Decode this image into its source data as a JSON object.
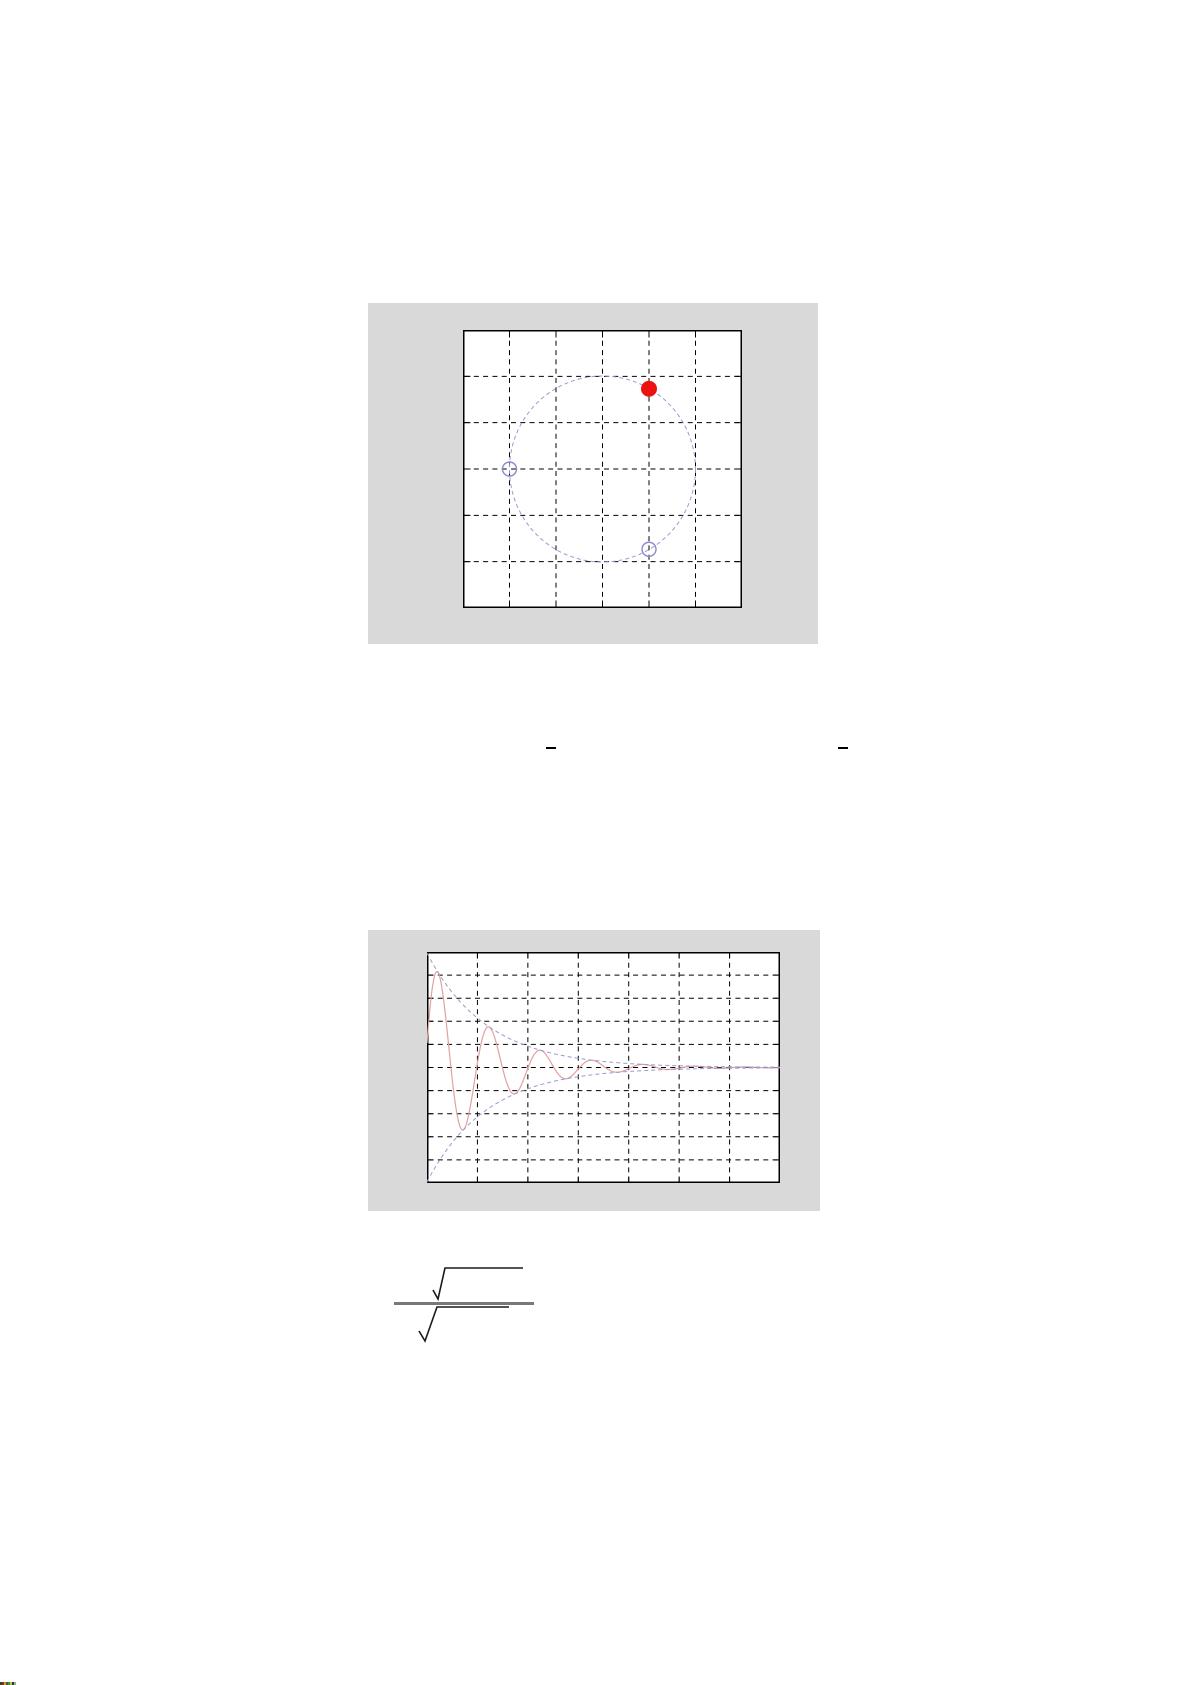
{
  "page": {
    "width": 1191,
    "height": 1685,
    "background": "#ffffff",
    "description": "White document page containing two MATLAB-style figures (a pole-zero unit-circle plot and a damped oscillation plot), two small minus-sign equation fragments, a fraction formula of which only the square-root radicals and bars rendered, and a tiny multicolored artifact strip in the bottom-left corner"
  },
  "panels": {
    "figure1_color": "#d9d9d9",
    "figure2_color": "#d9d9d9"
  },
  "chart_data": [
    {
      "type": "scatter",
      "name": "pole-zero-unit-circle-plot",
      "title": "",
      "xlabel": "",
      "ylabel": "",
      "xlim": [
        -1.5,
        1.5
      ],
      "ylim": [
        -1.5,
        1.5
      ],
      "grid": {
        "cols": 6,
        "rows": 6,
        "line_style": "dashed",
        "color": "#000000",
        "dash": "5,4.3"
      },
      "frame_color": "#000000",
      "frame_width": 1.5,
      "tick_len": 6,
      "unit_circle": {
        "cx": 0,
        "cy": 0,
        "radius": 1,
        "color": "#9a9ad2",
        "dash": "4,3",
        "width": 1
      },
      "points": [
        {
          "kind": "pole",
          "marker": "filled-circle",
          "x": 0.5,
          "y": 0.866,
          "color": "#ee1111",
          "radius_px": 7.5
        },
        {
          "kind": "zero",
          "marker": "open-circle",
          "x": -1.0,
          "y": 0.0,
          "color": "#8a8ace",
          "radius_px": 7
        },
        {
          "kind": "zero",
          "marker": "open-circle",
          "x": 0.5,
          "y": -0.866,
          "color": "#8a8ace",
          "radius_px": 7
        }
      ]
    },
    {
      "type": "line",
      "name": "damped-oscillation-plot",
      "title": "",
      "xlabel": "",
      "ylabel": "",
      "xlim": [
        0,
        7
      ],
      "ylim": [
        -5,
        5
      ],
      "grid": {
        "cols": 7,
        "rows": 10,
        "line_style": "dashed",
        "color": "#000000",
        "dash": "5,4.3"
      },
      "frame_color": "#000000",
      "frame_width": 1.5,
      "tick_len": 5,
      "series": [
        {
          "name": "damped-cosine",
          "color": "#e3a0a0",
          "width": 1.2,
          "dash": "",
          "model": {
            "kind": "damped_cosine",
            "amplitude": 4.95,
            "decay_tau": 1.19,
            "period": 1.02,
            "peak_x": 0.22,
            "midline": 0
          },
          "sample_step": 0.01
        },
        {
          "name": "upper-envelope",
          "color": "#9a9ad2",
          "width": 1,
          "dash": "4,3",
          "model": {
            "kind": "exp_envelope",
            "amplitude": 4.95,
            "decay_tau": 1.19,
            "sign": 1
          },
          "sample_step": 0.05
        },
        {
          "name": "lower-envelope",
          "color": "#9a9ad2",
          "width": 1,
          "dash": "4,3",
          "model": {
            "kind": "exp_envelope",
            "amplitude": 4.95,
            "decay_tau": 1.19,
            "sign": -1
          },
          "sample_step": 0.05
        }
      ]
    }
  ],
  "equation_marks": {
    "color": "#000000",
    "bars": [
      {
        "x": 546,
        "y": 747,
        "width": 10,
        "height": 2
      },
      {
        "x": 838,
        "y": 747,
        "width": 10,
        "height": 2
      }
    ]
  },
  "formula": {
    "description": "Fraction: square root expression over square root expression; only radical signs, vinculums and the fraction bar are visible",
    "stroke_color": "#1a1a1a",
    "stroke_width": 1.6,
    "bar": {
      "x": 6,
      "y": 44,
      "width": 140,
      "height": 3,
      "color": "#787878"
    },
    "radicals": [
      {
        "name": "numerator-radical",
        "points": [
          [
            45,
            32
          ],
          [
            50,
            41
          ],
          [
            57,
            10
          ],
          [
            135,
            10
          ]
        ]
      },
      {
        "name": "denominator-radical",
        "points": [
          [
            31,
            73
          ],
          [
            37,
            83
          ],
          [
            49,
            49
          ],
          [
            121,
            49
          ]
        ]
      }
    ]
  },
  "corner_artifact": {
    "x": 0,
    "y": 1682,
    "segment_width": 2,
    "height": 3,
    "colors": [
      "#4a3a28",
      "#8a3020",
      "#c8a438",
      "#55512a",
      "#3f8f46",
      "#b6c34a",
      "#23403a",
      "#9ab09a"
    ]
  }
}
